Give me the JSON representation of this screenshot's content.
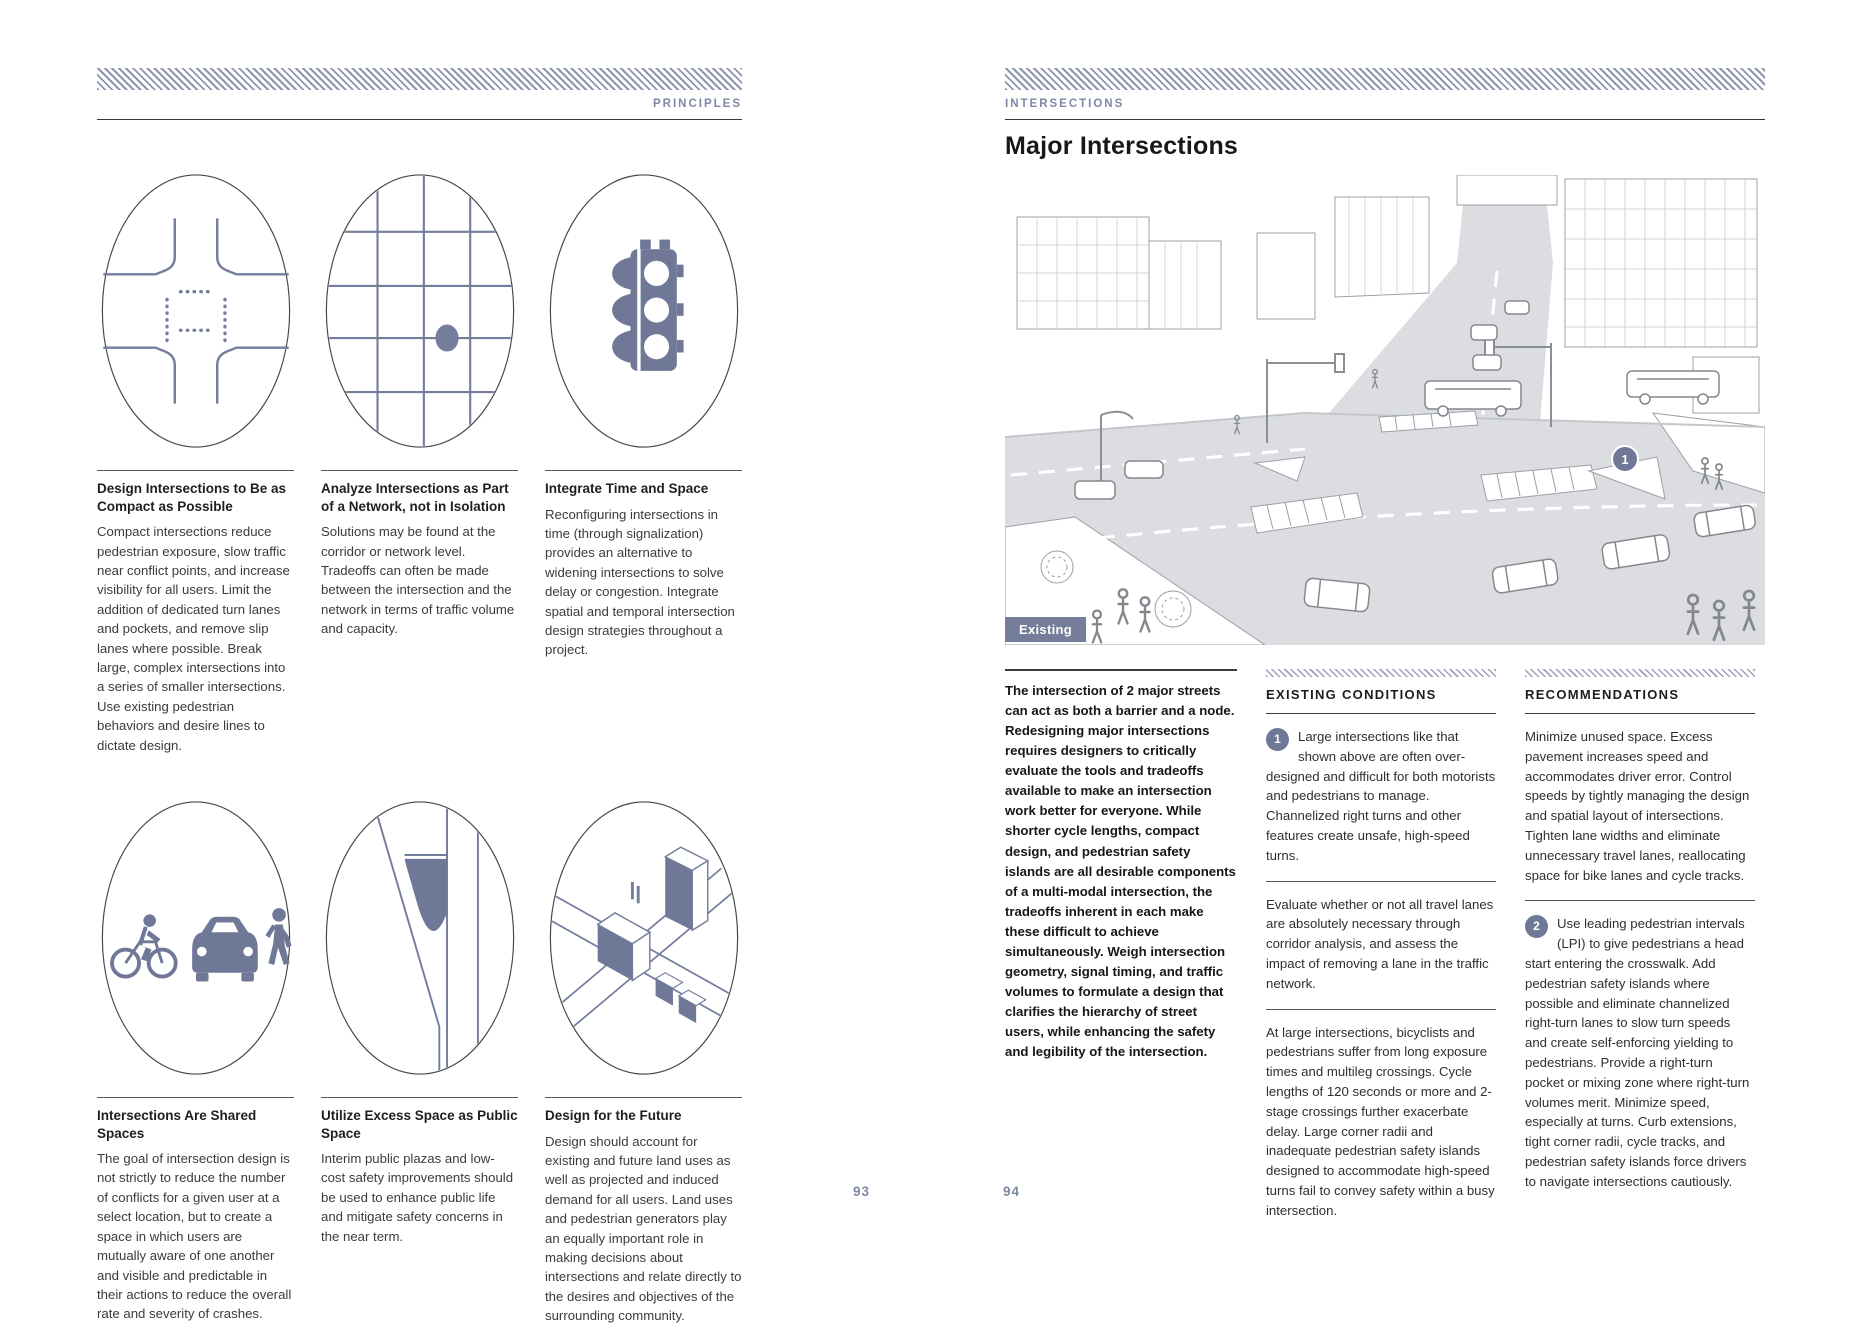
{
  "colors": {
    "accent": "#6F7896",
    "hatch": "#8D95AF",
    "kicker_text": "#7E88A6",
    "badge_background": "#747D99",
    "body_text": "#2F2F30"
  },
  "page_left": {
    "header_label": "PRINCIPLES",
    "page_number": "93",
    "principles": [
      {
        "icon": "compact-intersection-icon",
        "title": "Design Intersections to Be as Compact as Possible",
        "body": "Compact intersections reduce pedestrian exposure, slow traffic near conflict points, and increase visibility for all users. Limit the addition of dedicated turn lanes and pockets, and remove slip lanes where possible. Break large, complex intersections into a series of smaller intersections. Use existing pedestrian behaviors and desire lines to dictate design."
      },
      {
        "icon": "street-network-icon",
        "title": "Analyze Intersections as Part of a Network, not in Isolation",
        "body": "Solutions may be found at the corridor or network level. Tradeoffs can often be made between the intersection and the network in terms of traffic volume and capacity."
      },
      {
        "icon": "traffic-signal-icon",
        "title": "Integrate Time and Space",
        "body": "Reconfiguring intersections in time (through signalization) provides an alternative to widening intersections to solve delay or congestion. Integrate spatial and temporal intersection design strategies throughout a project."
      },
      {
        "icon": "multimodal-users-icon",
        "title": "Intersections Are Shared Spaces",
        "body": "The goal of intersection design is not strictly to reduce the number of conflicts for a given user at a select location, but to create a space in which users are mutually aware of one another and visible and predictable in their actions to reduce the overall rate and severity of crashes."
      },
      {
        "icon": "public-plaza-icon",
        "title": "Utilize Excess Space as Public Space",
        "body": "Interim public plazas and low-cost safety improvements should be used to enhance public life and mitigate safety concerns in the near term."
      },
      {
        "icon": "isometric-city-icon",
        "title": "Design for the Future",
        "body": "Design should account for existing and future land uses as well as projected and induced demand for all users. Land uses and pedestrian generators play an equally important role in making decisions about intersections and relate directly to the desires and objectives of the surrounding community."
      }
    ]
  },
  "page_right": {
    "header_label": "INTERSECTIONS",
    "page_number": "94",
    "title": "Major Intersections",
    "figure": {
      "badge_label": "Existing",
      "marker_label": "1",
      "description": "Line drawing of a large existing major intersection with buses, cars, pedestrians and channelized right turns"
    },
    "intro": "The intersection of 2 major streets can act as both a barrier and a node. Redesigning major intersections requires designers to critically evaluate the tools and tradeoffs available to make an intersection work better for everyone. While shorter cycle lengths, compact design, and pedestrian safety islands are all desirable components of a multi-modal intersection, the tradeoffs inherent in each make these difficult to achieve simultaneously. Weigh intersection geometry, signal timing, and traffic volumes to formulate a design that clarifies the hierarchy of street users, while enhancing the safety and legibility of the intersection.",
    "existing_conditions": {
      "heading": "EXISTING CONDITIONS",
      "items": [
        {
          "marker": "1",
          "text": "Large intersections like that shown above are often over-designed and difficult for both motorists and pedestrians to manage. Channelized right turns and other features create unsafe, high-speed turns."
        },
        {
          "marker": "",
          "text": "Evaluate whether or not all travel lanes are absolutely necessary through corridor analysis, and assess the impact of removing a lane in the traffic network."
        },
        {
          "marker": "",
          "text": "At large intersections, bicyclists and pedestrians suffer from long exposure times and multileg crossings. Cycle lengths of 120 seconds or more and 2-stage crossings further exacerbate delay. Large corner radii and inadequate pedestrian safety islands designed to accommodate high-speed turns fail to convey safety within a busy intersection."
        }
      ]
    },
    "recommendations": {
      "heading": "RECOMMENDATIONS",
      "items": [
        {
          "marker": "",
          "text": "Minimize unused space. Excess pavement increases speed and accommodates driver error. Control speeds by tightly managing the design and spatial layout of intersections. Tighten lane widths and eliminate unnecessary travel lanes, reallocating space for bike lanes and cycle tracks."
        },
        {
          "marker": "2",
          "text": "Use leading pedestrian intervals (LPI) to give pedestrians a head start entering the crosswalk. Add pedestrian safety islands where possible and eliminate channelized right-turn lanes to slow turn speeds and create self-enforcing yielding to pedestrians. Provide a right-turn pocket or mixing zone where right-turn volumes merit. Minimize speed, especially at turns. Curb extensions, tight corner radii, cycle tracks, and pedestrian safety islands force drivers to navigate intersections cautiously."
        }
      ]
    }
  }
}
